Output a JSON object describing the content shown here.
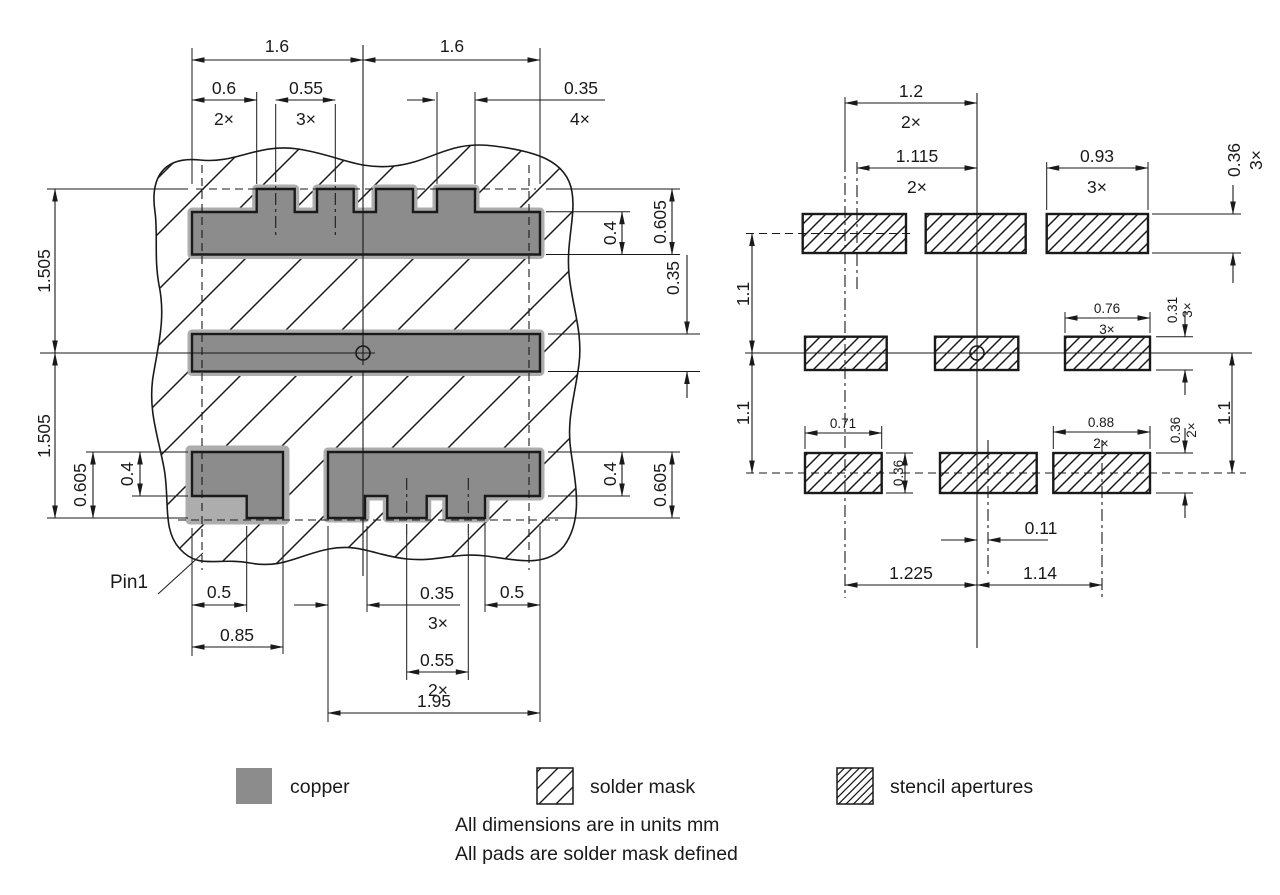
{
  "drawing": {
    "type": "pcb-land-pattern",
    "units_note": "All dimensions are in units mm",
    "pads_note": "All pads are solder mask defined"
  },
  "colors": {
    "line": "#1a1a1a",
    "copper_exposed": "#8c8c8c",
    "copper_masked": "#adadad"
  },
  "left_figure": {
    "dims": {
      "span_left": "1.6",
      "span_right": "1.6",
      "end_clearance": "0.6",
      "end_clearance_count": "2×",
      "top_notch_pitch": "0.55",
      "top_notch_pitch_count": "3×",
      "top_tab_width": "0.35",
      "top_tab_width_count": "4×",
      "row_pitch_upper": "1.505",
      "row_pitch_lower": "1.505",
      "bl_pad_height": "0.605",
      "bl_notch_height": "0.4",
      "tr_tab_height": "0.4",
      "tr_pad_height": "0.605",
      "center_pad_height": "0.35",
      "br_tab_height": "0.4",
      "br_pad_height": "0.605",
      "pin1": "Pin1",
      "bl_notch_width": "0.5",
      "bl_pad_width": "0.85",
      "bottom_tab_width": "0.35",
      "bottom_tab_width_count": "3×",
      "bottom_notch_pitch": "0.55",
      "bottom_notch_pitch_count": "2×",
      "br_pad_width": "1.95",
      "br_step_width": "0.5"
    }
  },
  "right_figure": {
    "dims": {
      "col_pitch_a": "1.2",
      "col_pitch_a_count": "2×",
      "col_pitch_b": "1.115",
      "col_pitch_b_count": "2×",
      "top_aperture_width": "0.93",
      "top_aperture_width_count": "3×",
      "top_aperture_height": "0.36",
      "top_aperture_height_count": "3×",
      "row_pitch_upper": "1.1",
      "row_pitch_lower": "1.1",
      "row_pitch_right": "1.1",
      "mid_aperture_width": "0.76",
      "mid_aperture_width_count": "3×",
      "mid_aperture_height": "0.31",
      "mid_aperture_height_count": "3×",
      "bl_aperture_width": "0.71",
      "bl_aperture_height": "0.36",
      "br_aperture_width": "0.88",
      "br_aperture_width_count": "2×",
      "br_aperture_height": "0.36",
      "br_aperture_height_count": "2×",
      "center_offset": "0.11",
      "bottom_col_pitch_left": "1.225",
      "bottom_col_pitch_right": "1.14"
    }
  },
  "legend": {
    "items": [
      {
        "label": "copper",
        "swatch": "solid-gray"
      },
      {
        "label": "solder mask",
        "swatch": "sparse-diagonal-hatch"
      },
      {
        "label": "stencil apertures",
        "swatch": "dense-diagonal-hatch"
      }
    ]
  },
  "notes": {
    "line1": "All dimensions are in units mm",
    "line2": "All pads are solder mask defined"
  }
}
